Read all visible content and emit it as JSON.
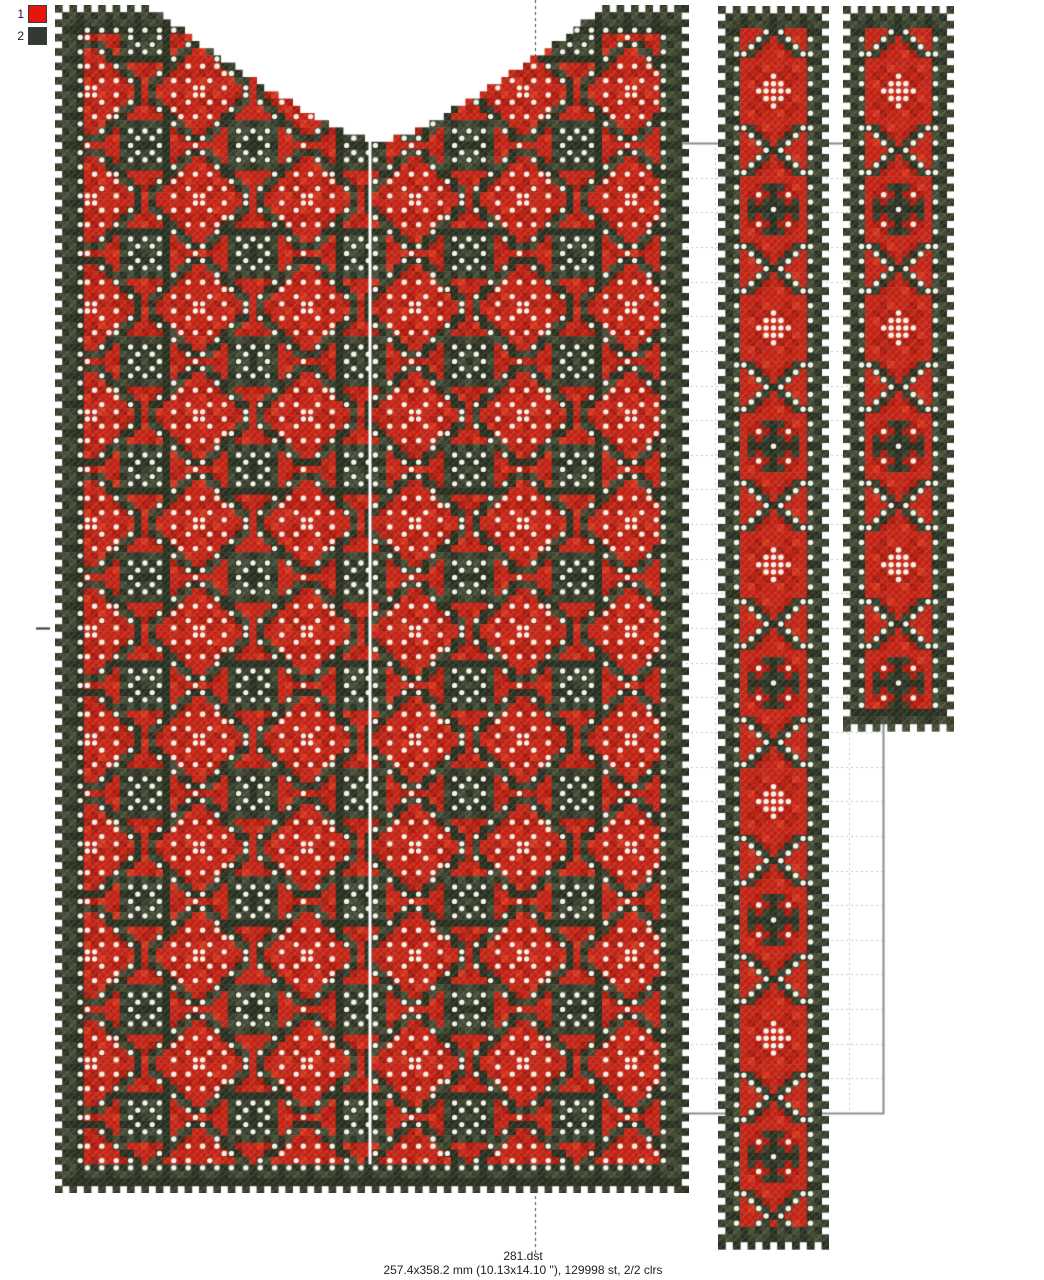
{
  "palette": {
    "items": [
      {
        "number": "1",
        "color": "#e8150c"
      },
      {
        "number": "2",
        "color": "#333a33"
      }
    ]
  },
  "footer": {
    "filename": "281.dst",
    "stats": "257.4x358.2 mm (10.13x14.10 \"), 129998 st, 2/2 clrs"
  },
  "design": {
    "colors": {
      "red": "#c62718",
      "red_dark": "#ac1e11",
      "red_light": "#d8371f",
      "dark": "#38402d",
      "dark_light": "#474f38",
      "dark_deep": "#2b3222",
      "white": "#f6f3ea",
      "bg": "#ffffff"
    },
    "guides": {
      "rect": {
        "x": 681,
        "y": 143,
        "w": 202,
        "h": 970,
        "stroke": "#8c8c8c"
      },
      "grid_cols": 6,
      "grid_rows": 28,
      "grid_color": "#c4c4c4",
      "centerline_x": 535,
      "centerline_color": "#4a4a4a",
      "centerline_segments": [
        [
          0,
          58
        ],
        [
          1196,
          1255
        ]
      ],
      "tick": {
        "x1": 36,
        "x2": 50,
        "y": 628,
        "color": "#333333"
      }
    },
    "panel": {
      "x": 55,
      "y": 5,
      "cols": 88,
      "rows": 165,
      "cell": 7.2,
      "neck": {
        "cx": 378,
        "rx": 225,
        "top": 8,
        "depth": 135,
        "exp": 1.27
      },
      "seam_x": 370,
      "lattice_period": 15
    },
    "bands": [
      {
        "x": 718,
        "y": 6,
        "cols": 15,
        "rows": 168,
        "cell": 7.4
      },
      {
        "x": 843,
        "y": 6,
        "cols": 15,
        "rows": 98,
        "cell": 7.4
      }
    ]
  }
}
